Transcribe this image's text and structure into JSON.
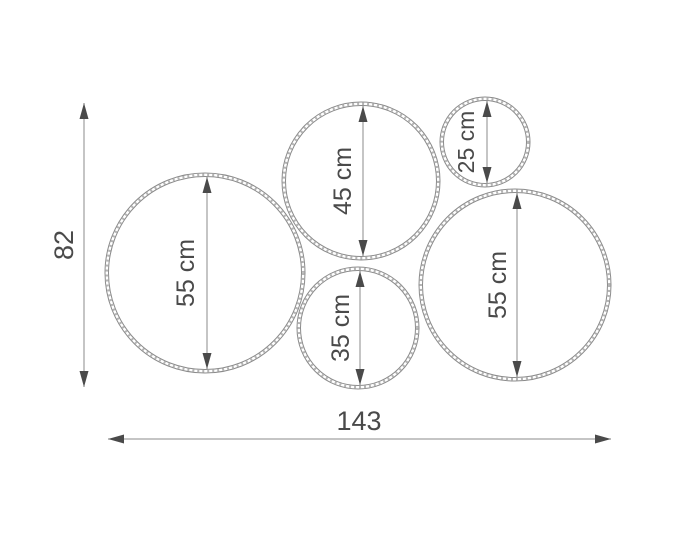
{
  "diagram": {
    "type": "dimension-drawing",
    "overall_dimensions": {
      "height_label": "82",
      "width_label": "143"
    },
    "circles": [
      {
        "position": "left-large",
        "label": "55 cm",
        "diameter_cm": 55
      },
      {
        "position": "top-middle",
        "label": "45 cm",
        "diameter_cm": 45
      },
      {
        "position": "top-right-small",
        "label": "25 cm",
        "diameter_cm": 25
      },
      {
        "position": "bottom-middle",
        "label": "35 cm",
        "diameter_cm": 35
      },
      {
        "position": "right-large",
        "label": "55 cm",
        "diameter_cm": 55
      }
    ],
    "colors": {
      "background": "#ffffff",
      "outline": "#8b8b8b",
      "hatch": "#b4b4b4",
      "arrow": "#4a4a4a",
      "text": "#4a4a4a"
    }
  }
}
